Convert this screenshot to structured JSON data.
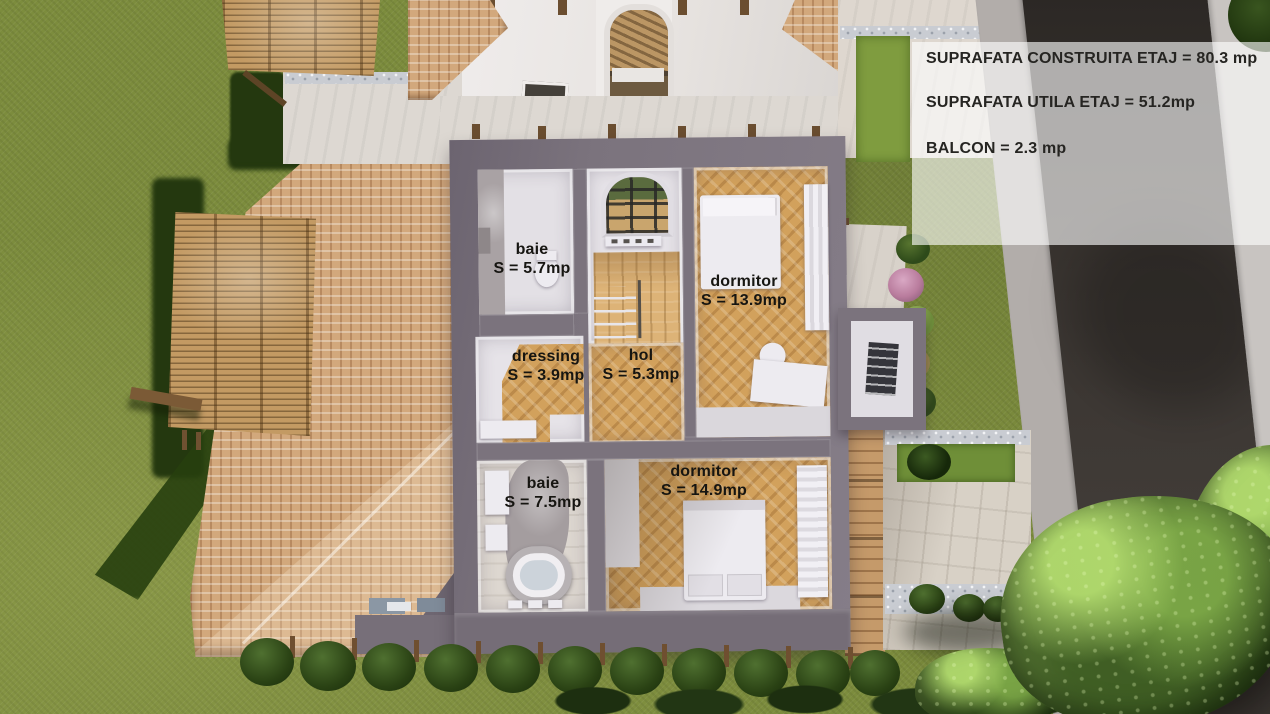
{
  "info_panel": {
    "lines": [
      "SUPRAFATA CONSTRUITA ETAJ = 80.3 mp",
      "SUPRAFATA UTILA ETAJ = 51.2mp",
      "BALCON = 2.3 mp"
    ]
  },
  "rooms": [
    {
      "name": "baie",
      "area": "S = 5.7mp"
    },
    {
      "name": "dormitor",
      "area": "S = 13.9mp"
    },
    {
      "name": "dressing",
      "area": "S = 3.9mp"
    },
    {
      "name": "hol",
      "area": "S = 5.3mp"
    },
    {
      "name": "baie",
      "area": "S = 7.5mp"
    },
    {
      "name": "dormitor",
      "area": "S = 14.9mp"
    }
  ],
  "colors": {
    "grass": "#7c8c3d",
    "roof_tile": "#d2a87c",
    "pergola_wood": "#c39a63",
    "plan_wall": "#7b737d",
    "parquet": "#d2a15c",
    "road_asphalt": "#393430",
    "sidewalk": "#b2adaa",
    "patio_stone": "#d8d1c6",
    "tree_green": "#557233",
    "info_panel_bg": "rgba(255,255,255,0.62)",
    "label_text": "#161511"
  }
}
